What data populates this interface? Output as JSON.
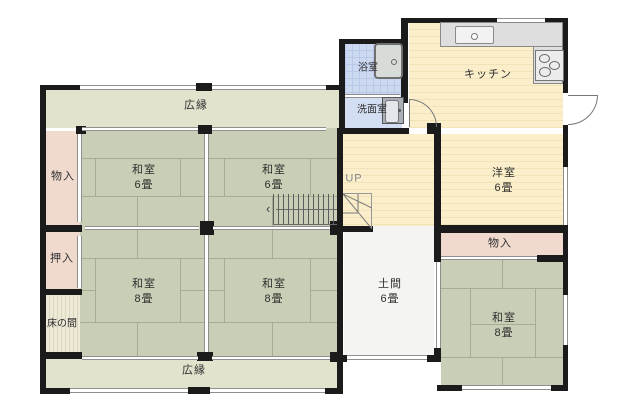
{
  "floorplan": {
    "rooms": {
      "engawa_top": {
        "name": "広縁"
      },
      "engawa_bottom": {
        "name": "広縁"
      },
      "storage_left": {
        "name": "物入"
      },
      "oshiire": {
        "name": "押入"
      },
      "tokonoma": {
        "name": "床の間"
      },
      "washitsu6_left": {
        "name": "和室",
        "size": "6畳"
      },
      "washitsu6_right": {
        "name": "和室",
        "size": "6畳"
      },
      "washitsu8_left": {
        "name": "和室",
        "size": "8畳"
      },
      "washitsu8_right": {
        "name": "和室",
        "size": "8畳"
      },
      "bathroom": {
        "name": "浴室"
      },
      "washroom": {
        "name": "洗面室"
      },
      "kitchen": {
        "name": "キッチン"
      },
      "youshitsu": {
        "name": "洋室",
        "size": "6畳"
      },
      "storage_right": {
        "name": "物入"
      },
      "doma": {
        "name": "土間",
        "size": "6畳"
      },
      "washitsu8_east": {
        "name": "和室",
        "size": "8畳"
      }
    },
    "stairs": {
      "label": "UP",
      "arrow": "‹"
    },
    "fixtures": {
      "bathtub": "bathtub-icon",
      "washbasin": "washbasin-icon",
      "kitchen_sink": "kitchen-sink-icon",
      "stove": "stove-3-burner-icon",
      "entrance_door": "door-swing-icon",
      "washroom_door": "door-swing-icon"
    },
    "colors": {
      "tatami": "#c9cfb6",
      "engawa": "#e2e3cc",
      "closet_pink": "#f0d9cd",
      "bath_blue": "#cdd9f0",
      "western_cream": "#faeecb",
      "doma_white": "#f4f4f2",
      "wall": "#1b1b1b"
    }
  }
}
